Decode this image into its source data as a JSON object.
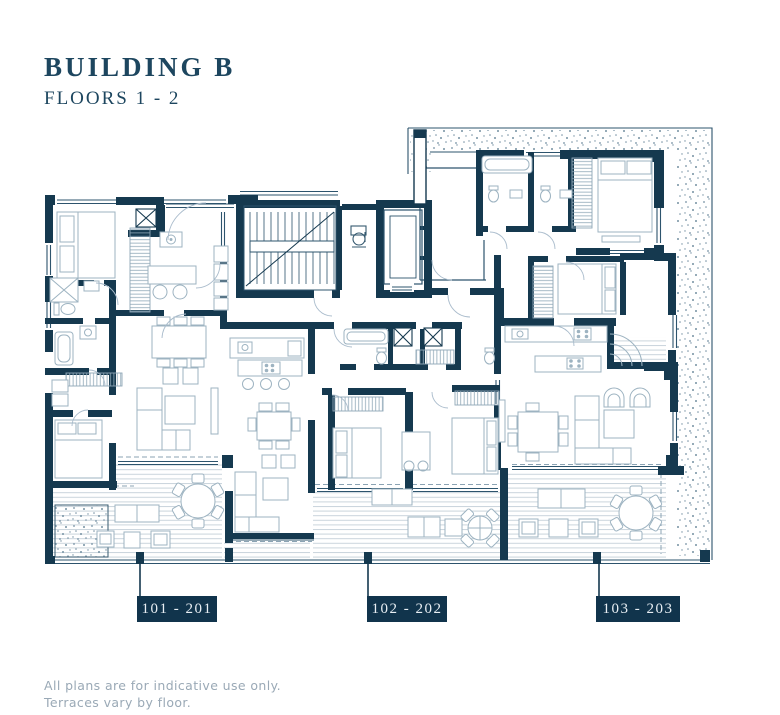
{
  "title": "BUILDING B",
  "subtitle": "FLOORS 1 - 2",
  "units": [
    {
      "label": "101 - 201"
    },
    {
      "label": "102 - 202"
    },
    {
      "label": "103 - 203"
    }
  ],
  "footer": {
    "line1": "All plans are for indicative use only.",
    "line2": "Terraces vary by floor."
  },
  "colors": {
    "wall": "#15394f",
    "label_bg": "#11344c",
    "label_text": "#e9eff4",
    "title_text": "#1d465f",
    "furniture": "#9db3c1",
    "deck_line": "#c9d4dc",
    "stipple": "#7490a2",
    "muted_text": "#9aa9b6"
  }
}
